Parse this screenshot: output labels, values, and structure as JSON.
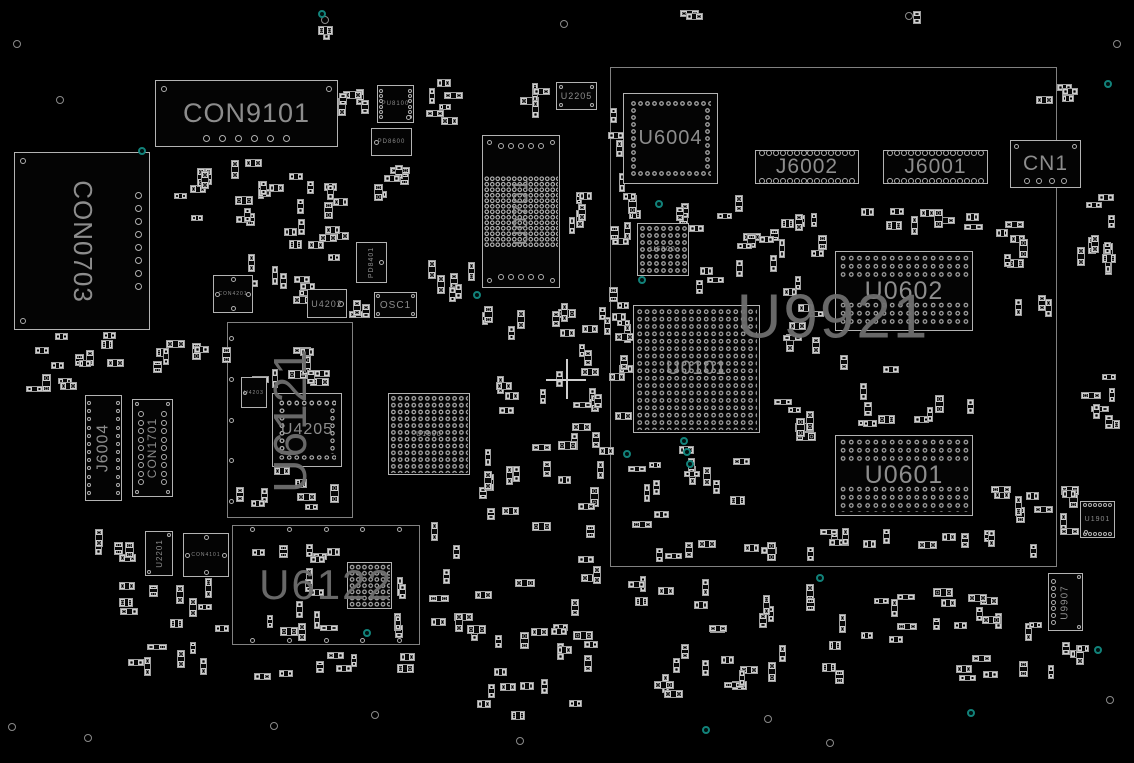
{
  "board": {
    "w": 1134,
    "h": 763,
    "bg": "#000000",
    "outline": "#b3b3b3",
    "label_color": "#8d8d8d",
    "module_label_color": "#6e6e6e",
    "dim_label_color": "#9a9a9a",
    "teal": "#12827a",
    "hole_color": "#8a8a8a",
    "cross_color": "#cfcfcf"
  },
  "modules": [
    {
      "ref": "U9921",
      "label": "U9921",
      "x": 610,
      "y": 67,
      "w": 447,
      "h": 500,
      "fs": 62,
      "lx": 833,
      "ly": 317,
      "deco": []
    },
    {
      "ref": "U6121",
      "label": "U6121",
      "x": 227,
      "y": 322,
      "w": 126,
      "h": 196,
      "fs": 46,
      "rot": "ccw",
      "deco": [
        {
          "t": "col",
          "edge": "left",
          "n": 5,
          "d": 5,
          "inset": 2,
          "margin": 14
        }
      ]
    },
    {
      "ref": "U6122",
      "label": "U6122",
      "x": 232,
      "y": 525,
      "w": 188,
      "h": 120,
      "fs": 42,
      "deco": [
        {
          "t": "row",
          "edge": "top",
          "n": 5,
          "d": 5,
          "inset": 2,
          "margin": 18
        },
        {
          "t": "row",
          "edge": "bottom",
          "n": 5,
          "d": 5,
          "inset": 2,
          "margin": 18
        }
      ]
    }
  ],
  "components": [
    {
      "ref": "CON9101",
      "label": "CON9101",
      "x": 155,
      "y": 80,
      "w": 183,
      "h": 67,
      "fs": 27,
      "deco": [
        {
          "t": "corners",
          "c": "tl,tr",
          "d": 6,
          "inset": 6
        },
        {
          "t": "row",
          "edge": "bottom",
          "n": 6,
          "d": 7,
          "inset": 5,
          "margin": 48
        }
      ]
    },
    {
      "ref": "CON0703",
      "label": "CON0703",
      "x": 14,
      "y": 152,
      "w": 136,
      "h": 178,
      "fs": 26,
      "rot": "cw",
      "deco": [
        {
          "t": "corners",
          "c": "tl,bl",
          "d": 6,
          "inset": 6
        },
        {
          "t": "col",
          "edge": "right",
          "n": 8,
          "d": 7,
          "inset": 8,
          "margin": 40
        }
      ]
    },
    {
      "ref": "PU8100",
      "label": "PU8100",
      "x": 377,
      "y": 85,
      "w": 37,
      "h": 38,
      "fs": 6,
      "deco": [
        {
          "t": "col",
          "edge": "left",
          "n": 6,
          "d": 4,
          "inset": 2,
          "margin": 4
        },
        {
          "t": "col",
          "edge": "right",
          "n": 6,
          "d": 4,
          "inset": 2,
          "margin": 4
        },
        {
          "t": "pin",
          "pos": "br",
          "d": 5,
          "inset": 3
        }
      ]
    },
    {
      "ref": "PD8600",
      "label": "PD8600",
      "x": 371,
      "y": 128,
      "w": 41,
      "h": 28,
      "fs": 6,
      "deco": [
        {
          "t": "pin",
          "pos": "ml",
          "d": 5,
          "inset": 3
        }
      ]
    },
    {
      "ref": "U2205",
      "label": "U2205",
      "x": 556,
      "y": 82,
      "w": 41,
      "h": 28,
      "fs": 9,
      "deco": [
        {
          "t": "corners",
          "c": "tl,tr,bl,br",
          "d": 4,
          "inset": 3
        }
      ]
    },
    {
      "ref": "U0701",
      "label": "U0701",
      "x": 482,
      "y": 135,
      "w": 78,
      "h": 153,
      "fs": 21,
      "rot": "ccw",
      "deco": [
        {
          "t": "corners",
          "c": "tl,tr,bl,br",
          "d": 5,
          "inset": 5
        },
        {
          "t": "row",
          "edge": "top",
          "n": 5,
          "d": 6,
          "inset": 8,
          "margin": 16
        },
        {
          "t": "row",
          "edge": "bottom",
          "n": 5,
          "d": 6,
          "inset": 8,
          "margin": 16
        },
        {
          "t": "grid",
          "rx": 0.03,
          "ry": 0.27,
          "rw": 0.94,
          "rh": 0.46,
          "cell": 5.5
        }
      ]
    },
    {
      "ref": "U6004",
      "label": "U6004",
      "x": 623,
      "y": 93,
      "w": 95,
      "h": 91,
      "fs": 20,
      "deco": [
        {
          "t": "ring",
          "inset": 7,
          "cell": 7
        }
      ]
    },
    {
      "ref": "J6002",
      "label": "J6002",
      "x": 755,
      "y": 150,
      "w": 104,
      "h": 34,
      "fs": 21,
      "deco": [
        {
          "t": "row",
          "edge": "top",
          "n": 14,
          "d": 6,
          "inset": 0,
          "margin": 4
        },
        {
          "t": "row",
          "edge": "bottom",
          "n": 14,
          "d": 6,
          "inset": 0,
          "margin": 4
        }
      ]
    },
    {
      "ref": "J6001",
      "label": "J6001",
      "x": 883,
      "y": 150,
      "w": 105,
      "h": 34,
      "fs": 21,
      "deco": [
        {
          "t": "row",
          "edge": "top",
          "n": 14,
          "d": 6,
          "inset": 0,
          "margin": 4
        },
        {
          "t": "row",
          "edge": "bottom",
          "n": 14,
          "d": 6,
          "inset": 0,
          "margin": 4
        }
      ]
    },
    {
      "ref": "CN1",
      "label": "CN1",
      "x": 1010,
      "y": 140,
      "w": 71,
      "h": 48,
      "fs": 21,
      "deco": [
        {
          "t": "corners",
          "c": "tl,tr",
          "d": 5,
          "inset": 4
        },
        {
          "t": "row",
          "edge": "bottom",
          "n": 4,
          "d": 6,
          "inset": 4,
          "margin": 14
        }
      ]
    },
    {
      "ref": "U6300",
      "label": "U6300",
      "x": 637,
      "y": 223,
      "w": 52,
      "h": 53,
      "fs": 7,
      "dim": true,
      "deco": [
        {
          "t": "grid",
          "rx": 0.04,
          "ry": 0.04,
          "rw": 0.92,
          "rh": 0.92,
          "cell": 7
        }
      ]
    },
    {
      "ref": "U0602",
      "label": "U0602",
      "x": 835,
      "y": 251,
      "w": 138,
      "h": 80,
      "fs": 25,
      "deco": [
        {
          "t": "grid",
          "rx": 0.03,
          "ry": 0.04,
          "rw": 0.94,
          "rh": 0.31,
          "cell": 8.2
        },
        {
          "t": "grid",
          "rx": 0.03,
          "ry": 0.62,
          "rw": 0.94,
          "rh": 0.33,
          "cell": 8.2
        }
      ]
    },
    {
      "ref": "U0601",
      "label": "U0601",
      "x": 835,
      "y": 435,
      "w": 138,
      "h": 81,
      "fs": 25,
      "deco": [
        {
          "t": "grid",
          "rx": 0.03,
          "ry": 0.04,
          "rw": 0.94,
          "rh": 0.31,
          "cell": 8.2
        },
        {
          "t": "grid",
          "rx": 0.03,
          "ry": 0.62,
          "rw": 0.94,
          "rh": 0.33,
          "cell": 8.2
        }
      ]
    },
    {
      "ref": "U0101",
      "label": "U0101",
      "x": 633,
      "y": 305,
      "w": 127,
      "h": 128,
      "fs": 19,
      "deco": [
        {
          "t": "grid",
          "rx": 0.02,
          "ry": 0.02,
          "rw": 0.96,
          "rh": 0.96,
          "cell": 7.4
        }
      ]
    },
    {
      "ref": "J6004",
      "label": "J6004",
      "x": 85,
      "y": 395,
      "w": 37,
      "h": 106,
      "fs": 16,
      "rot": "ccw",
      "deco": [
        {
          "t": "col",
          "edge": "left",
          "n": 12,
          "d": 4,
          "inset": 2,
          "margin": 6
        },
        {
          "t": "col",
          "edge": "right",
          "n": 12,
          "d": 4,
          "inset": 2,
          "margin": 6
        }
      ]
    },
    {
      "ref": "CON1701",
      "label": "CON1701",
      "x": 132,
      "y": 399,
      "w": 41,
      "h": 98,
      "fs": 12,
      "rot": "ccw",
      "deco": [
        {
          "t": "corners",
          "c": "tl,tr,bl,br",
          "d": 4,
          "inset": 3
        },
        {
          "t": "col",
          "edge": "left",
          "n": 9,
          "d": 6,
          "inset": 6,
          "margin": 12
        },
        {
          "t": "col",
          "edge": "right",
          "n": 9,
          "d": 6,
          "inset": 6,
          "margin": 12
        }
      ]
    },
    {
      "ref": "CON4201",
      "label": "CON4201",
      "x": 213,
      "y": 275,
      "w": 40,
      "h": 38,
      "fs": 5,
      "deco": [
        {
          "t": "pin",
          "pos": "ml",
          "d": 5,
          "inset": 2
        },
        {
          "t": "pin",
          "pos": "mr",
          "d": 5,
          "inset": 2
        },
        {
          "t": "pin",
          "pos": "tc",
          "d": 5,
          "inset": 2
        },
        {
          "t": "pin",
          "pos": "bc",
          "d": 5,
          "inset": 2
        }
      ]
    },
    {
      "ref": "U4202",
      "label": "U4202",
      "x": 307,
      "y": 289,
      "w": 40,
      "h": 29,
      "fs": 9,
      "deco": [
        {
          "t": "pin",
          "pos": "mr",
          "d": 6,
          "inset": 3
        }
      ]
    },
    {
      "ref": "OSC1",
      "label": "OSC1",
      "x": 374,
      "y": 292,
      "w": 43,
      "h": 26,
      "fs": 10,
      "deco": [
        {
          "t": "corners",
          "c": "tl,tr,bl,br",
          "d": 4,
          "inset": 2
        }
      ]
    },
    {
      "ref": "PD8401",
      "label": "PD8401",
      "x": 356,
      "y": 242,
      "w": 31,
      "h": 41,
      "fs": 7,
      "rot": "ccw",
      "deco": [
        {
          "t": "pin",
          "pos": "mr",
          "d": 5,
          "inset": 3
        }
      ]
    },
    {
      "ref": "U4203",
      "label": "U4203",
      "x": 241,
      "y": 377,
      "w": 26,
      "h": 31,
      "fs": 5,
      "deco": [
        {
          "t": "pin",
          "pos": "ml",
          "d": 4,
          "inset": 2
        }
      ]
    },
    {
      "ref": "U4205",
      "label": "U4205",
      "x": 272,
      "y": 393,
      "w": 70,
      "h": 74,
      "fs": 16,
      "deco": [
        {
          "t": "ring",
          "inset": 6,
          "cell": 7.5
        }
      ]
    },
    {
      "ref": "U1900",
      "label": "U1900",
      "x": 388,
      "y": 393,
      "w": 82,
      "h": 82,
      "fs": 7,
      "dim": true,
      "deco": [
        {
          "t": "grid",
          "rx": 0.03,
          "ry": 0.03,
          "rw": 0.94,
          "rh": 0.94,
          "cell": 6.8
        }
      ]
    },
    {
      "ref": "U2201",
      "label": "U2201",
      "x": 145,
      "y": 531,
      "w": 28,
      "h": 45,
      "fs": 8,
      "rot": "ccw",
      "deco": [
        {
          "t": "pin",
          "pos": "tr",
          "d": 4,
          "inset": 2
        },
        {
          "t": "pin",
          "pos": "bl",
          "d": 4,
          "inset": 2
        }
      ]
    },
    {
      "ref": "CON4101",
      "label": "CON4101",
      "x": 183,
      "y": 533,
      "w": 46,
      "h": 44,
      "fs": 5,
      "deco": [
        {
          "t": "pin",
          "pos": "ml",
          "d": 5,
          "inset": 2
        },
        {
          "t": "pin",
          "pos": "mr",
          "d": 5,
          "inset": 2
        },
        {
          "t": "pin",
          "pos": "tc",
          "d": 5,
          "inset": 2
        },
        {
          "t": "pin",
          "pos": "bc",
          "d": 5,
          "inset": 2
        }
      ]
    },
    {
      "ref": "U6122BGA",
      "label": "",
      "x": 347,
      "y": 562,
      "w": 45,
      "h": 47,
      "fs": 5,
      "deco": [
        {
          "t": "grid",
          "rx": 0.05,
          "ry": 0.05,
          "rw": 0.9,
          "rh": 0.9,
          "cell": 6.2
        }
      ]
    },
    {
      "ref": "U1901",
      "label": "U1901",
      "x": 1080,
      "y": 501,
      "w": 35,
      "h": 37,
      "fs": 7,
      "deco": [
        {
          "t": "row",
          "edge": "top",
          "n": 6,
          "d": 4,
          "inset": 2,
          "margin": 3
        },
        {
          "t": "row",
          "edge": "bottom",
          "n": 6,
          "d": 4,
          "inset": 2,
          "margin": 3
        },
        {
          "t": "pin",
          "pos": "bl",
          "d": 4,
          "inset": 4
        }
      ]
    },
    {
      "ref": "U9907",
      "label": "U9907",
      "x": 1048,
      "y": 573,
      "w": 35,
      "h": 58,
      "fs": 10,
      "rot": "ccw",
      "deco": [
        {
          "t": "col",
          "edge": "left",
          "n": 7,
          "d": 5,
          "inset": 3,
          "margin": 6
        },
        {
          "t": "pin",
          "pos": "tr",
          "d": 4,
          "inset": 2
        },
        {
          "t": "pin",
          "pos": "br",
          "d": 4,
          "inset": 2
        }
      ]
    }
  ],
  "passive_clusters": [
    [
      338,
      83,
      35,
      50,
      5
    ],
    [
      415,
      78,
      55,
      50,
      6
    ],
    [
      352,
      160,
      60,
      58,
      6
    ],
    [
      225,
      155,
      125,
      95,
      24
    ],
    [
      160,
      158,
      60,
      85,
      6
    ],
    [
      228,
      250,
      118,
      66,
      10
    ],
    [
      348,
      297,
      24,
      22,
      3
    ],
    [
      420,
      248,
      62,
      62,
      6
    ],
    [
      468,
      300,
      150,
      115,
      16
    ],
    [
      478,
      418,
      145,
      112,
      16
    ],
    [
      558,
      300,
      48,
      215,
      12
    ],
    [
      515,
      82,
      35,
      40,
      4
    ],
    [
      545,
      190,
      65,
      50,
      6
    ],
    [
      606,
      88,
      26,
      160,
      9
    ],
    [
      608,
      255,
      26,
      175,
      10
    ],
    [
      618,
      188,
      125,
      50,
      9
    ],
    [
      695,
      198,
      125,
      100,
      13
    ],
    [
      755,
      212,
      75,
      45,
      6
    ],
    [
      762,
      300,
      65,
      60,
      6
    ],
    [
      840,
      200,
      150,
      38,
      9
    ],
    [
      995,
      215,
      58,
      115,
      9
    ],
    [
      1058,
      228,
      60,
      55,
      6
    ],
    [
      1075,
      365,
      45,
      95,
      7
    ],
    [
      1060,
      480,
      18,
      85,
      5
    ],
    [
      758,
      358,
      72,
      85,
      7
    ],
    [
      830,
      352,
      160,
      78,
      11
    ],
    [
      625,
      440,
      135,
      98,
      14
    ],
    [
      635,
      535,
      180,
      28,
      8
    ],
    [
      812,
      528,
      195,
      22,
      12
    ],
    [
      988,
      478,
      70,
      85,
      7
    ],
    [
      608,
      572,
      215,
      62,
      13
    ],
    [
      838,
      588,
      205,
      55,
      18
    ],
    [
      648,
      640,
      200,
      55,
      9
    ],
    [
      948,
      648,
      115,
      35,
      6
    ],
    [
      1040,
      640,
      58,
      28,
      4
    ],
    [
      1083,
      190,
      40,
      70,
      6
    ],
    [
      1030,
      75,
      60,
      35,
      4
    ],
    [
      422,
      520,
      190,
      138,
      20
    ],
    [
      480,
      622,
      130,
      55,
      8
    ],
    [
      470,
      675,
      150,
      45,
      7
    ],
    [
      640,
      655,
      150,
      50,
      7
    ],
    [
      232,
      652,
      190,
      30,
      8
    ],
    [
      118,
      578,
      112,
      55,
      10
    ],
    [
      122,
      638,
      95,
      38,
      6
    ],
    [
      92,
      518,
      48,
      60,
      5
    ],
    [
      28,
      328,
      132,
      42,
      9
    ],
    [
      152,
      338,
      80,
      45,
      7
    ],
    [
      18,
      368,
      60,
      28,
      4
    ],
    [
      232,
      328,
      118,
      60,
      9
    ],
    [
      232,
      462,
      118,
      52,
      8
    ],
    [
      238,
      543,
      105,
      98,
      12
    ],
    [
      394,
      555,
      24,
      85,
      5
    ],
    [
      300,
      543,
      48,
      20,
      3
    ],
    [
      675,
      8,
      30,
      16,
      2
    ],
    [
      898,
      10,
      25,
      15,
      2
    ],
    [
      310,
      25,
      25,
      15,
      2
    ]
  ],
  "teal_points": [
    [
      322,
      14
    ],
    [
      142,
      151
    ],
    [
      477,
      295
    ],
    [
      659,
      204
    ],
    [
      642,
      280
    ],
    [
      627,
      454
    ],
    [
      684,
      441
    ],
    [
      687,
      452
    ],
    [
      690,
      464
    ],
    [
      820,
      578
    ],
    [
      706,
      730
    ],
    [
      971,
      713
    ],
    [
      1108,
      84
    ],
    [
      367,
      633
    ],
    [
      1098,
      650
    ]
  ],
  "holes": [
    [
      17,
      44
    ],
    [
      60,
      100
    ],
    [
      325,
      20
    ],
    [
      564,
      24
    ],
    [
      909,
      16
    ],
    [
      1117,
      44
    ],
    [
      12,
      727
    ],
    [
      88,
      738
    ],
    [
      274,
      726
    ],
    [
      375,
      715
    ],
    [
      520,
      741
    ],
    [
      768,
      719
    ],
    [
      830,
      743
    ],
    [
      1110,
      700
    ]
  ],
  "crosshair": {
    "x": 566,
    "y": 379,
    "arm": 20
  }
}
